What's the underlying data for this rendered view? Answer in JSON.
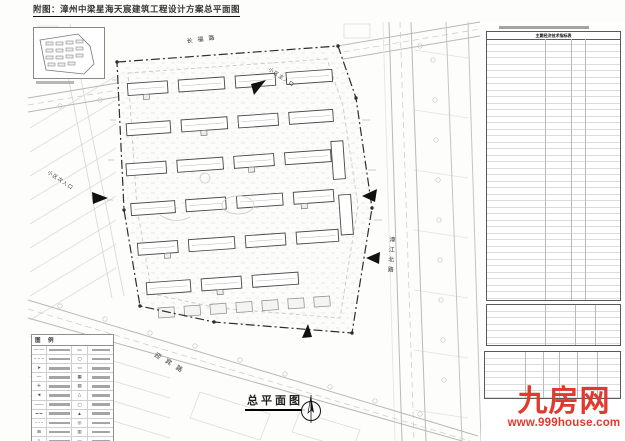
{
  "page": {
    "title": "附图：漳州中梁星海天宸建筑工程设计方案总平面图"
  },
  "plan": {
    "label": "总平面图",
    "roads": {
      "top": "长福路",
      "right": "漳江北路",
      "bottom": "迎宾路"
    },
    "entrances": {
      "main": "小区主入口",
      "secondary": "小区次入口"
    }
  },
  "panel": {
    "main_table_title": "主要经济技术指标表"
  },
  "legend": {
    "title": "图 例",
    "rows": [
      {
        "s1": "—·—",
        "s2": "▭"
      },
      {
        "s1": "– – –",
        "s2": "▢"
      },
      {
        "s1": "➤",
        "s2": "▭"
      },
      {
        "s1": "—",
        "s2": "▦"
      },
      {
        "s1": "✛",
        "s2": "▨"
      },
      {
        "s1": "◄",
        "s2": "△"
      },
      {
        "s1": "——",
        "s2": "▢"
      },
      {
        "s1": "━ ━",
        "s2": "▲"
      },
      {
        "s1": "⋯⋯",
        "s2": "◎"
      },
      {
        "s1": "⊞",
        "s2": "▥"
      },
      {
        "s1": "≡",
        "s2": "▭"
      }
    ]
  },
  "watermark": {
    "name": "九房网",
    "url": "www.999house.com",
    "color": "#e2392e"
  }
}
